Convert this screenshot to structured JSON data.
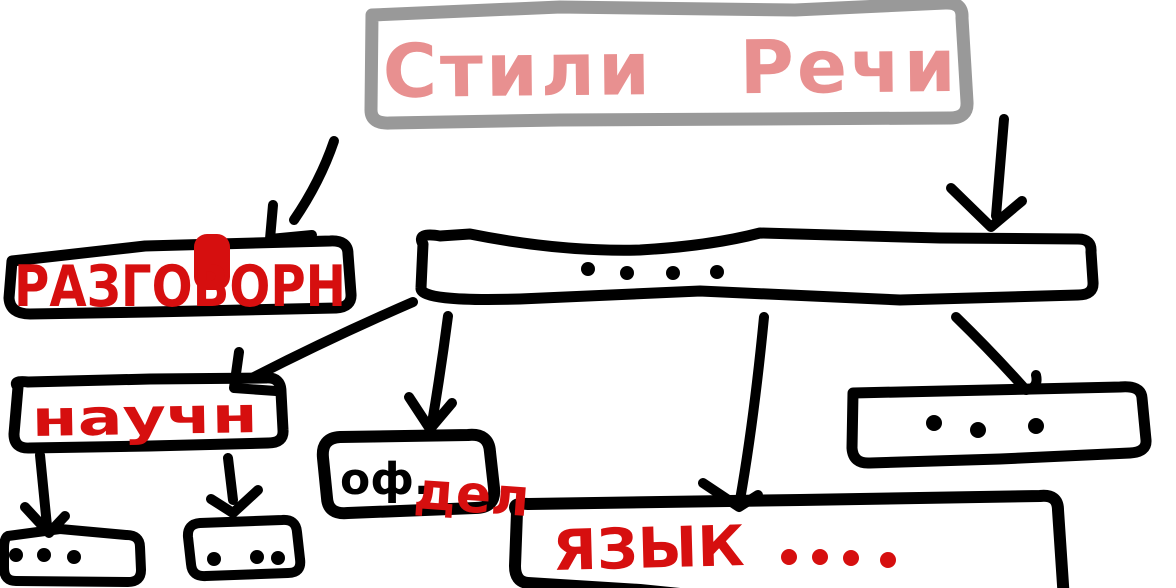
{
  "canvas": {
    "width": 1176,
    "height": 588,
    "background": "#ffffff"
  },
  "colors": {
    "ink": "#000000",
    "red": "#d60f0f",
    "pink": "#e89090",
    "gray": "#999999",
    "box_fill": "#ffffff"
  },
  "title": {
    "label": "Стили Речи"
  },
  "nodes": {
    "razgovorn": {
      "label": "РАЗГОВОРН"
    },
    "big_placeholder": {
      "dots": 4
    },
    "nauchn": {
      "label": "научн"
    },
    "ofdel": {
      "black_part": "оф.",
      "red_part": "дел"
    },
    "yazyk": {
      "label": "ЯЗЫК",
      "dots": 4
    },
    "right_placeholder": {
      "dots": 3
    },
    "left_small_placeholder": {
      "dots": 3
    },
    "right_small_placeholder": {
      "dots": 3
    }
  },
  "edges": [
    {
      "from": "title",
      "to": "razgovorn"
    },
    {
      "from": "title",
      "to": "big_placeholder"
    },
    {
      "from": "big_placeholder",
      "to": "nauchn"
    },
    {
      "from": "big_placeholder",
      "to": "ofdel"
    },
    {
      "from": "big_placeholder",
      "to": "yazyk"
    },
    {
      "from": "big_placeholder",
      "to": "right_placeholder"
    },
    {
      "from": "nauchn",
      "to": "left_small_placeholder"
    },
    {
      "from": "nauchn",
      "to": "right_small_placeholder"
    }
  ]
}
